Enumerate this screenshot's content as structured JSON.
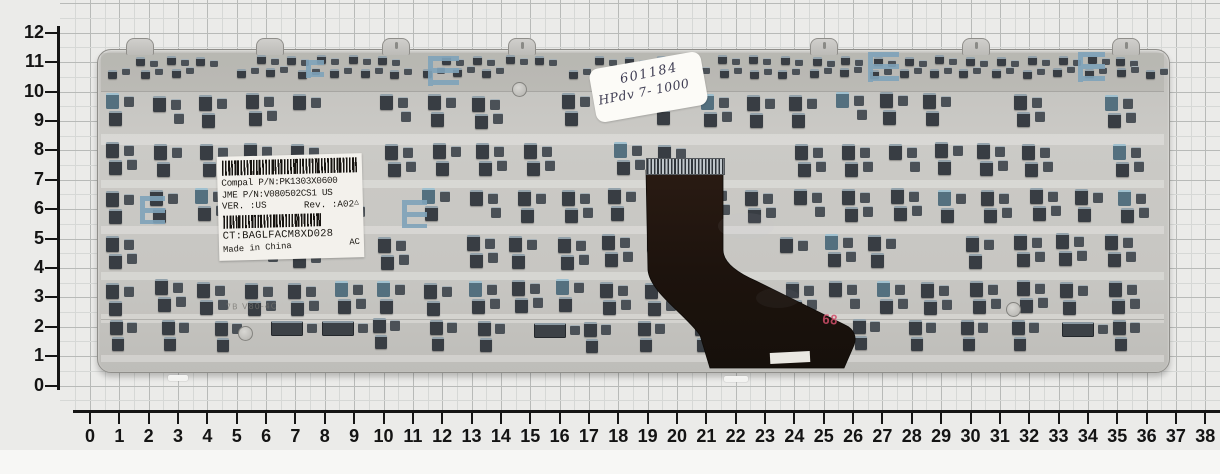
{
  "rulers": {
    "left": {
      "labels": [
        "0",
        "1",
        "2",
        "3",
        "4",
        "5",
        "6",
        "7",
        "8",
        "9",
        "10",
        "11",
        "12"
      ]
    },
    "bottom": {
      "labels": [
        "0",
        "1",
        "2",
        "3",
        "4",
        "5",
        "6",
        "7",
        "8",
        "9",
        "10",
        "11",
        "12",
        "13",
        "14",
        "15",
        "16",
        "17",
        "18",
        "19",
        "20",
        "21",
        "22",
        "23",
        "24",
        "25",
        "26",
        "27",
        "28",
        "29",
        "30",
        "31",
        "32",
        "33",
        "34",
        "35",
        "36",
        "37",
        "38"
      ]
    }
  },
  "label": {
    "line_compal": "Compal P/N:PK1303X0600",
    "line_jme": "JME P/N:V080502CS1 US",
    "line_ver": "VER. :US",
    "line_rev": "Rev. :A02",
    "line_ct": "CT:BAGLFACM8XD028",
    "line_made": "Made in China",
    "line_ac": "AC"
  },
  "note": {
    "line1": "601184",
    "line2": "HPdv 7- 1000"
  },
  "marks": {
    "red_stamp": "68",
    "embossed_code": "7B V80-4C"
  },
  "icons": {
    "warning_triangle": "△"
  },
  "colors": {
    "paper": "#ebebe9",
    "plate": "#c7c6c2",
    "clip_dark": "#383d43",
    "clip_blue": "#7fa3ba",
    "cable": "#20150e",
    "stamp_red": "#d14f6b"
  }
}
